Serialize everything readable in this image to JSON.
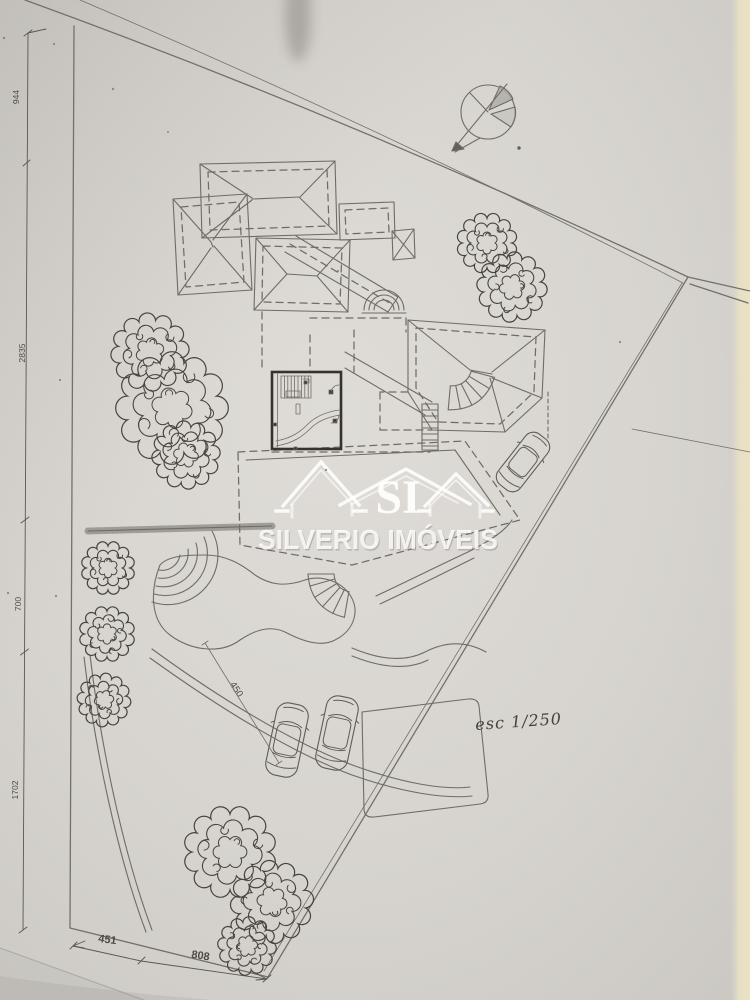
{
  "watermark": {
    "monogram": "SI",
    "brand": "SILVERIO IMÓVEIS"
  },
  "dimensions": {
    "left": [
      "944",
      "2835",
      "700",
      "1702"
    ],
    "bottom": [
      "451",
      "808"
    ],
    "driveway": "450"
  },
  "notes": {
    "scale": "esc 1/250"
  },
  "icons": {
    "north": "north-arrow-icon",
    "tree": "tree-scribble-icon",
    "car": "car-top-view-icon"
  },
  "colors": {
    "paper": "#d8d5d0",
    "paper_edge": "#e9e1c6",
    "ink": "#6f6c65",
    "ink_dark": "#35332d",
    "watermark": "#ffffff"
  }
}
